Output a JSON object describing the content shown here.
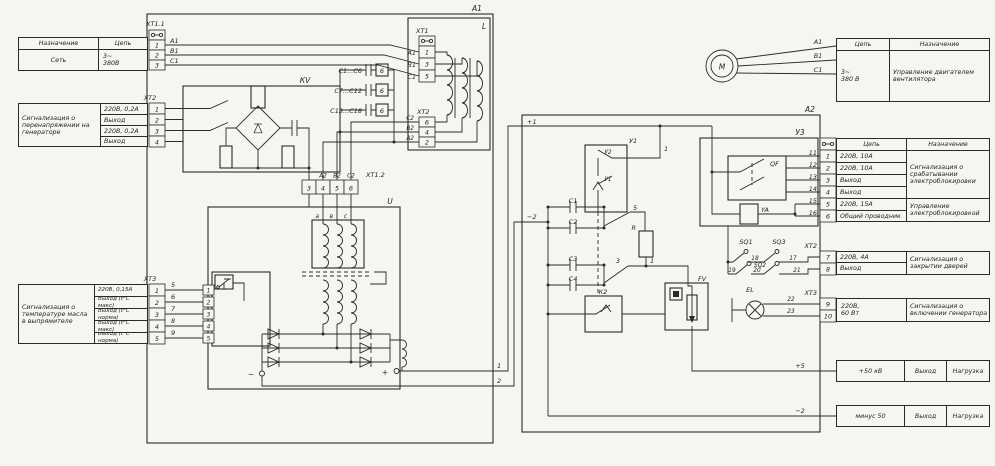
{
  "colors": {
    "paper": "#f6f5f1",
    "ink": "#2b2a26"
  },
  "left": {
    "net": {
      "col_purpose": "Назначение",
      "col_circuit": "Цепь",
      "purpose": "Сеть",
      "circuit_top": "3~",
      "circuit_bottom": "380В",
      "connector": "ХТ1.1",
      "pins": [
        "1",
        "2",
        "3"
      ],
      "wires": [
        "А1",
        "В1",
        "С1"
      ]
    },
    "overvoltage": {
      "purpose": "Сигнализация о перенапряжении на генераторе",
      "circuits": [
        "220В, 0,2А",
        "Выход",
        "220В, 0,2А",
        "Выход"
      ],
      "connector": "ХТ2",
      "pins": [
        "1",
        "2",
        "3",
        "4"
      ]
    },
    "temperature": {
      "purpose": "Сигнализация о температуре масла в выпрямителе",
      "circuits": [
        "220В, 0,15А",
        "Выход (t°C макс)",
        "Выход (t°C норма)",
        "Выход (t°C макс)",
        "Выход (t°C норма)"
      ],
      "connector": "ХТ3",
      "pins": [
        "1",
        "2",
        "3",
        "4",
        "5"
      ],
      "wires": [
        "5",
        "6",
        "7",
        "8",
        "9"
      ]
    }
  },
  "right": {
    "motor": {
      "label": "М",
      "wires": [
        "А1",
        "В1",
        "С1"
      ],
      "col_circuit": "Цепь",
      "col_purpose": "Назначение",
      "circuit_top": "3~",
      "circuit_bottom": "380 В",
      "purpose": "Управление двигателем вентилятора"
    },
    "interlock": {
      "col_circuit": "Цепь",
      "col_purpose": "Назначение",
      "pins": [
        "1",
        "2",
        "3",
        "4",
        "5",
        "6"
      ],
      "wires": [
        "11",
        "12",
        "13",
        "14",
        "15",
        "16"
      ],
      "circuits": [
        "220В, 10А",
        "220В, 10А",
        "Выход",
        "Выход",
        "220В, 15А",
        "Общий проводник"
      ],
      "purpose_top": "Сигнализация о срабатывании электроблокировки",
      "purpose_bottom": "Управление электроблокировкой"
    },
    "doors": {
      "connector": "ХТ2",
      "pins": [
        "7",
        "8"
      ],
      "circuits": [
        "220В, 4А",
        "Выход"
      ],
      "purpose": "Сигнализация о закрытии дверей"
    },
    "lamp": {
      "connector": "ХТ3",
      "pins": [
        "9",
        "10"
      ],
      "circuit_top": "220В,",
      "circuit_bottom": "60 Вт",
      "purpose": "Сигнализация о включении генератора"
    },
    "hv_plus": {
      "circuit": "+50 кВ",
      "io": "Выход",
      "load": "Нагрузка",
      "wire": "+5"
    },
    "hv_minus": {
      "circuit": "минус 50",
      "io": "Выход",
      "load": "Нагрузка",
      "wire": "−2"
    }
  },
  "sch": {
    "a1": "А1",
    "l": "L",
    "xt1": "ХТ1",
    "xt1_pins": [
      "1",
      "3",
      "5"
    ],
    "xt1_wires": [
      "А1",
      "В1",
      "С1"
    ],
    "xt2": "ХТ2",
    "xt2_pins": [
      "6",
      "4",
      "2"
    ],
    "xt2_wires": [
      "С2",
      "В2",
      "А2"
    ],
    "kv": "КV",
    "banks": [
      {
        "label": "С1...С6",
        "n": "6"
      },
      {
        "label": "С7...С12",
        "n": "6"
      },
      {
        "label": "С13...С18",
        "n": "6"
      }
    ],
    "xt12": "ХТ1.2",
    "xt12_pins": [
      "3",
      "4",
      "5",
      "6"
    ],
    "xt12_wires": [
      "А2",
      "В2",
      "С2"
    ],
    "u": "U",
    "taps": [
      "а",
      "в",
      "с"
    ],
    "sensor_pins": [
      "1",
      "2",
      "3",
      "4",
      "5"
    ],
    "minus": "−",
    "plus": "+",
    "w_plus": "1",
    "w_minus": "2",
    "a2": "А2",
    "in_plus": "+1",
    "in_minus": "−2",
    "y1": "У1",
    "y2": "У2",
    "y1i": "У1",
    "c1": "С1",
    "c2": "С2",
    "c3": "С3",
    "c4": "С4",
    "k2": "К2",
    "r": "R",
    "n5": "5",
    "n3": "3",
    "n1": "1",
    "fv": "FV",
    "u3": "У3",
    "qf": "QF",
    "ya": "YA",
    "sq1": "SQ1",
    "sq2": "SQ2",
    "sq3": "SQ3",
    "sq_w": [
      "18",
      "17",
      "19",
      "20",
      "21"
    ],
    "el": "EL",
    "el_w": [
      "22",
      "23"
    ]
  }
}
